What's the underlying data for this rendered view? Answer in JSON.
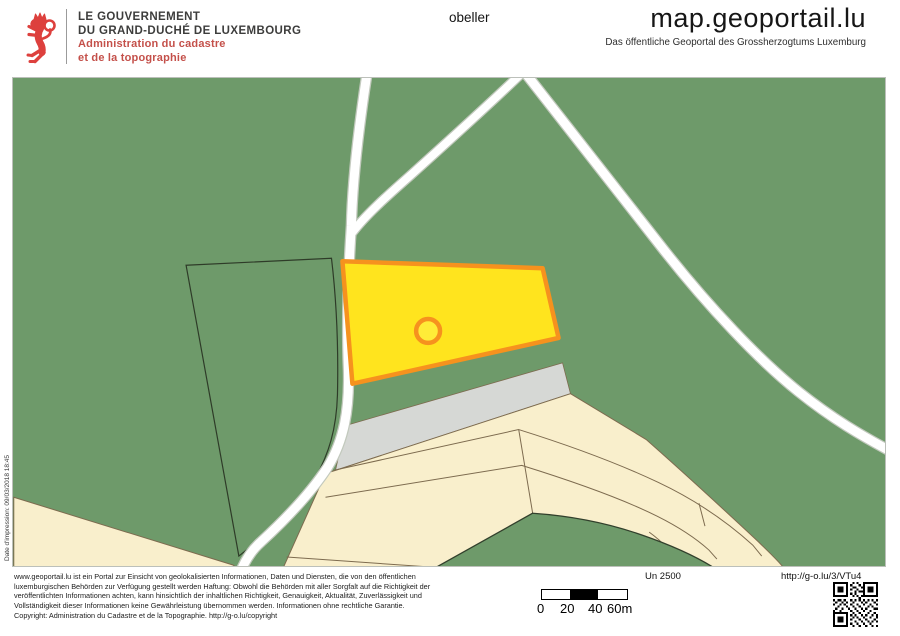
{
  "header": {
    "logo": {
      "line1": "LE GOUVERNEMENT",
      "line2": "DU GRAND-DUCHÉ DE LUXEMBOURG",
      "line3": "Administration du cadastre",
      "line4": "et de la topographie"
    },
    "map_label": "obeller",
    "site_title": "map.geoportail.lu",
    "site_subtitle": "Das öffentliche Geoportal des Grossherzogtums Luxemburg"
  },
  "map": {
    "print_date": "Date d'impression: 09/03/2018 18:45",
    "colors": {
      "background_green": "#6e9a6a",
      "parcel_highlight_fill": "#ffe41e",
      "parcel_highlight_stroke": "#f6921e",
      "built_zone_beige": "#f9efcc",
      "road_strip_gray": "#d6d8d5",
      "road_white": "#ffffff",
      "boundary_dark": "#2e3b28",
      "parcel_line_brown": "#7d6b4f",
      "brand_red": "#dd403d"
    }
  },
  "footer": {
    "disclaimer_lines": [
      "www.geoportail.lu ist ein Portal zur Einsicht von geolokalisierten Informationen, Daten und Diensten, die von den öffentlichen",
      "luxemburgischen Behörden zur Verfügung gestellt werden Haftung: Obwohl die Behörden mit aller Sorgfalt auf die Richtigkeit der",
      "veröffentlichten Informationen achten, kann hinsichtlich der inhaltlichen Richtigkeit, Genauigkeit, Aktualität, Zuverlässigkeit und",
      "Vollständigkeit dieser Informationen keine Gewährleistung übernommen werden. Informationen ohne rechtliche Garantie.",
      "Copyright: Administration du Cadastre et de la Topographie. http://g-o.lu/copyright"
    ],
    "scale_text": "Un 2500",
    "share_url": "http://g-o.lu/3/VTu4",
    "scalebar_labels": [
      "0",
      "20",
      "40",
      "60m"
    ]
  }
}
